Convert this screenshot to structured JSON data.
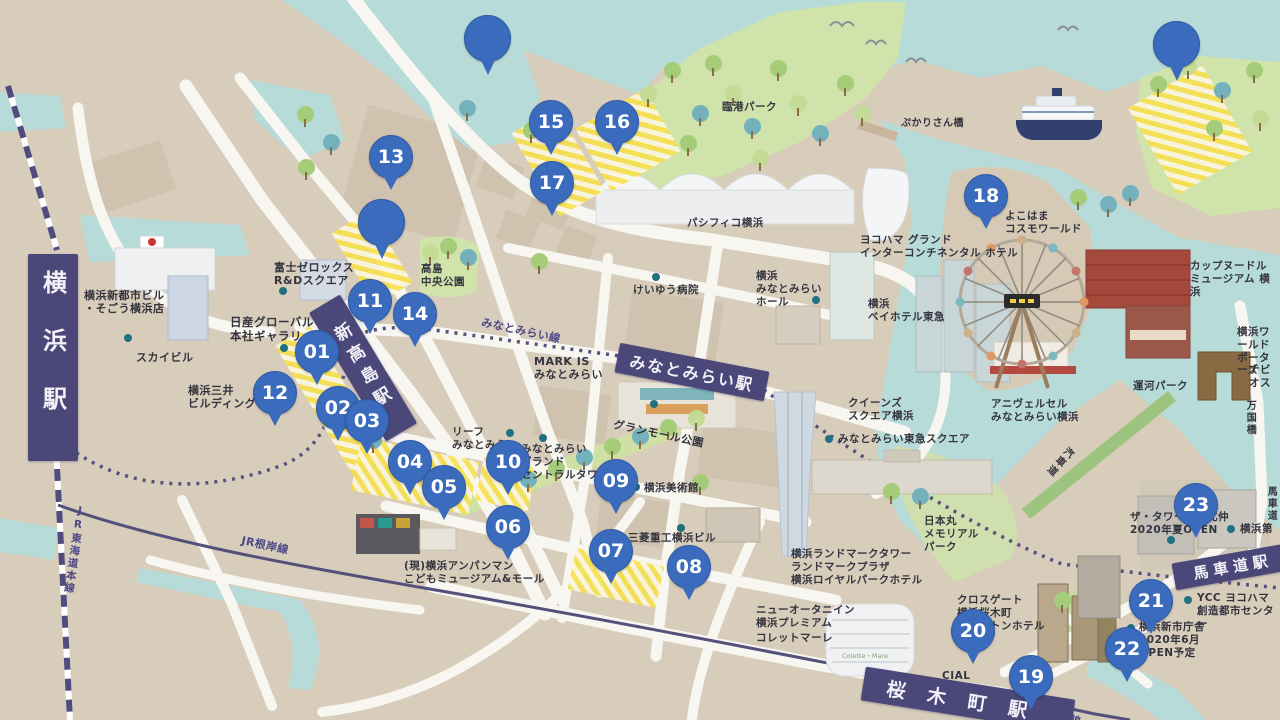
{
  "title": "横浜みなとみらい イラストマップ",
  "colors": {
    "land": "#d8cdbb",
    "water": "#b7dbd8",
    "park": "#cfe3ab",
    "road": "#f8f6f1",
    "rail_purple": "#514c80",
    "station_band": "#4b4778",
    "marker_blue": "#3a6bbd",
    "zone_yellow": "#f6e04e",
    "label_dark": "#34343f"
  },
  "stations": [
    {
      "id": "yokohama",
      "label": "横浜駅",
      "cx": 53,
      "cy": 357,
      "w": 50,
      "h": 207,
      "rot": 0,
      "v": true,
      "fs": 24,
      "ls": 34
    },
    {
      "id": "shin-takashima",
      "label": "新高島駅",
      "cx": 363,
      "cy": 368,
      "w": 36,
      "h": 150,
      "rot": -31,
      "v": true,
      "fs": 17,
      "ls": 8
    },
    {
      "id": "minatomirai",
      "label": "みなとみらい駅",
      "cx": 692,
      "cy": 372,
      "w": 152,
      "h": 30,
      "rot": 11,
      "v": false,
      "fs": 16,
      "ls": 2
    },
    {
      "id": "sakuragicho",
      "label": "桜木町駅",
      "cx": 968,
      "cy": 700,
      "w": 212,
      "h": 34,
      "rot": 9,
      "v": false,
      "fs": 19,
      "ls": 22
    },
    {
      "id": "bashamichi",
      "label": "馬車道駅",
      "cx": 1233,
      "cy": 566,
      "w": 120,
      "h": 27,
      "rot": -10,
      "v": false,
      "fs": 15,
      "ls": 5
    }
  ],
  "markers": [
    {
      "n": "01",
      "x": 317,
      "y": 352
    },
    {
      "n": "02",
      "x": 338,
      "y": 408
    },
    {
      "n": "03",
      "x": 367,
      "y": 421
    },
    {
      "n": "04",
      "x": 410,
      "y": 462
    },
    {
      "n": "05",
      "x": 444,
      "y": 487
    },
    {
      "n": "06",
      "x": 508,
      "y": 527
    },
    {
      "n": "07",
      "x": 611,
      "y": 551
    },
    {
      "n": "08",
      "x": 689,
      "y": 567
    },
    {
      "n": "09",
      "x": 616,
      "y": 481
    },
    {
      "n": "10",
      "x": 508,
      "y": 462
    },
    {
      "n": "11",
      "x": 370,
      "y": 301
    },
    {
      "n": "12",
      "x": 275,
      "y": 393
    },
    {
      "n": "13",
      "x": 391,
      "y": 157
    },
    {
      "n": "14",
      "x": 415,
      "y": 314
    },
    {
      "n": "15",
      "x": 551,
      "y": 122
    },
    {
      "n": "16",
      "x": 617,
      "y": 122
    },
    {
      "n": "17",
      "x": 552,
      "y": 183
    },
    {
      "n": "18",
      "x": 986,
      "y": 196
    },
    {
      "n": "19",
      "x": 1031,
      "y": 677
    },
    {
      "n": "20",
      "x": 973,
      "y": 631
    },
    {
      "n": "21",
      "x": 1151,
      "y": 601
    },
    {
      "n": "22",
      "x": 1127,
      "y": 649
    },
    {
      "n": "23",
      "x": 1196,
      "y": 505
    }
  ],
  "pins": [
    {
      "x": 487,
      "y": 38
    },
    {
      "x": 381,
      "y": 222
    },
    {
      "x": 1176,
      "y": 44
    }
  ],
  "labels": [
    {
      "id": "sogo",
      "t": "横浜新都市ビル\n・そごう横浜店",
      "x": 84,
      "y": 289,
      "fs": 11
    },
    {
      "id": "sky-building",
      "t": "スカイビル",
      "x": 136,
      "y": 351,
      "fs": 11
    },
    {
      "id": "nissan-gallery",
      "t": "日産グローバル\n本社ギャラリー",
      "x": 230,
      "y": 315,
      "fs": 11.5
    },
    {
      "id": "fuji-xerox",
      "t": "富士ゼロックス\nR&Dスクエア",
      "x": 274,
      "y": 261,
      "fs": 11
    },
    {
      "id": "mitsui-building",
      "t": "横浜三井\nビルディング",
      "x": 188,
      "y": 384,
      "fs": 11
    },
    {
      "id": "takashima-central-park",
      "t": "高島\n中央公園",
      "x": 421,
      "y": 263,
      "fs": 10.5
    },
    {
      "id": "keiyu-hospital",
      "t": "けいゆう病院",
      "x": 633,
      "y": 284,
      "fs": 10.5
    },
    {
      "id": "minatomirai-line",
      "t": "みなとみらい線",
      "x": 483,
      "y": 316,
      "fs": 11,
      "rot": 12,
      "c": "rail"
    },
    {
      "id": "mark-is",
      "t": "MARK IS\nみなとみらい",
      "x": 534,
      "y": 355,
      "fs": 11
    },
    {
      "id": "leaf-minatomirai",
      "t": "リーフ\nみなとみらい",
      "x": 452,
      "y": 426,
      "fs": 10.5
    },
    {
      "id": "grand-central-tower",
      "t": "みなとみらい\nグランド\nセントラルタワー",
      "x": 521,
      "y": 443,
      "fs": 10.5
    },
    {
      "id": "grandmall-park",
      "t": "グランモール公園",
      "x": 615,
      "y": 418,
      "fs": 11,
      "rot": 12
    },
    {
      "id": "museum-of-art",
      "t": "横浜美術館",
      "x": 644,
      "y": 482,
      "fs": 10.5
    },
    {
      "id": "mitsubishi-building",
      "t": "三菱重工横浜ビル",
      "x": 628,
      "y": 532,
      "fs": 10.5
    },
    {
      "id": "anpanman-museum",
      "t": "(現)横浜アンパンマン\nこどもミュージアム&モール",
      "x": 404,
      "y": 560,
      "fs": 10.5
    },
    {
      "id": "jr-negishi-line",
      "t": "JR根岸線",
      "x": 243,
      "y": 534,
      "fs": 11,
      "rot": 12,
      "c": "rail"
    },
    {
      "id": "rinko-park",
      "t": "臨港パーク",
      "x": 722,
      "y": 101,
      "fs": 10.5
    },
    {
      "id": "pukarisan-bridge",
      "t": "ぷかりさん橋",
      "x": 901,
      "y": 118,
      "fs": 10
    },
    {
      "id": "pacifico",
      "t": "パシフィコ横浜",
      "x": 687,
      "y": 217,
      "fs": 10.5
    },
    {
      "id": "intercontinental",
      "t": "ヨコハマ グランド\nインターコンチネンタル ホテル",
      "x": 860,
      "y": 234,
      "fs": 10.5
    },
    {
      "id": "cosmo-world",
      "t": "よこはま\nコスモワールド",
      "x": 1005,
      "y": 210,
      "fs": 10.5
    },
    {
      "id": "cupnoodles-museum",
      "t": "カップヌードル\nミュージアム 横浜",
      "x": 1190,
      "y": 260,
      "fs": 10.5
    },
    {
      "id": "mm-hall",
      "t": "横浜\nみなとみらい\nホール",
      "x": 756,
      "y": 270,
      "fs": 10.5
    },
    {
      "id": "bay-hotel",
      "t": "横浜\nベイホテル東急",
      "x": 868,
      "y": 298,
      "fs": 10.5
    },
    {
      "id": "queens-square",
      "t": "クイーンズ\nスクエア横浜",
      "x": 848,
      "y": 397,
      "fs": 10.5
    },
    {
      "id": "tokyu-square",
      "t": "みなとみらい東急スクエア",
      "x": 838,
      "y": 433,
      "fs": 10.5
    },
    {
      "id": "anniversaire",
      "t": "アニヴェルセル\nみなとみらい横浜",
      "x": 991,
      "y": 398,
      "fs": 10.5
    },
    {
      "id": "unga-park",
      "t": "運河パーク",
      "x": 1133,
      "y": 380,
      "fs": 10.5
    },
    {
      "id": "world-porters",
      "t": "横浜ワールド\nポーターズ",
      "x": 1237,
      "y": 326,
      "fs": 10.5
    },
    {
      "id": "navios",
      "t": "ナビオス",
      "x": 1249,
      "y": 364,
      "fs": 10.5
    },
    {
      "id": "bankoku-bridge",
      "t": "万国橋",
      "x": 1243,
      "y": 400,
      "fs": 10,
      "v": true
    },
    {
      "id": "kishamichi",
      "t": "汽車道",
      "x": 1066,
      "y": 443,
      "fs": 10,
      "v": true,
      "rot": 42
    },
    {
      "id": "nippon-maru-park",
      "t": "日本丸\nメモリアル\nパーク",
      "x": 924,
      "y": 515,
      "fs": 10.5
    },
    {
      "id": "landmark-tower",
      "t": "横浜ランドマークタワー\nランドマークプラザ\n横浜ロイヤルパークホテル",
      "x": 791,
      "y": 548,
      "fs": 10.5
    },
    {
      "id": "new-otani-inn",
      "t": "ニューオータニイン\n横浜プレミアム",
      "x": 756,
      "y": 604,
      "fs": 10.5
    },
    {
      "id": "colette-mare",
      "t": "コレットマーレ",
      "x": 756,
      "y": 632,
      "fs": 10.5
    },
    {
      "id": "colette-sign",
      "t": "Colette・Mare",
      "x": 842,
      "y": 653,
      "fs": 6.5,
      "c": "sign"
    },
    {
      "id": "crossgate",
      "t": "クロスゲート\n横浜桜木町\nワシントンホテル",
      "x": 957,
      "y": 594,
      "fs": 10.5
    },
    {
      "id": "cial-sakuragicho",
      "t": "CIAL\n桜木町",
      "x": 942,
      "y": 670,
      "fs": 10.5
    },
    {
      "id": "ycc",
      "t": "YCC ヨコハマ\n創造都市センター",
      "x": 1197,
      "y": 592,
      "fs": 10.5
    },
    {
      "id": "new-city-hall",
      "t": "横浜新市庁舎\n2020年6月\nOPEN予定",
      "x": 1139,
      "y": 621,
      "fs": 10.5
    },
    {
      "id": "tower-kitanaka",
      "t": "ザ・タワー横浜北仲\n2020年夏OPEN",
      "x": 1130,
      "y": 511,
      "fs": 10.5
    },
    {
      "id": "yokohama-daini",
      "t": "横浜第",
      "x": 1240,
      "y": 523,
      "fs": 10.5
    },
    {
      "id": "bashamichi-street",
      "t": "馬車道",
      "x": 1264,
      "y": 486,
      "fs": 10,
      "v": true
    },
    {
      "id": "jr-tokaido-line",
      "t": "JR東海道本線",
      "x": 74,
      "y": 504,
      "fs": 10.5,
      "v": true,
      "rot": 8,
      "c": "rail"
    },
    {
      "id": "jr-negishi-line-2",
      "t": "JR根岸線",
      "x": 1038,
      "y": 704,
      "fs": 10.5,
      "rot": 16,
      "c": "rail"
    }
  ],
  "zones": [
    {
      "cx": 372,
      "cy": 258,
      "w": 44,
      "h": 84,
      "rot": -31
    },
    {
      "cx": 331,
      "cy": 400,
      "w": 40,
      "h": 150,
      "rot": -31
    },
    {
      "cx": 558,
      "cy": 162,
      "w": 52,
      "h": 96,
      "rot": -30
    },
    {
      "cx": 628,
      "cy": 140,
      "w": 80,
      "h": 72,
      "rot": -30
    },
    {
      "cx": 415,
      "cy": 476,
      "w": 120,
      "h": 54,
      "rot": 12
    },
    {
      "cx": 506,
      "cy": 484,
      "w": 54,
      "h": 44,
      "rot": 12
    },
    {
      "cx": 616,
      "cy": 578,
      "w": 90,
      "h": 42,
      "rot": 12
    },
    {
      "cx": 1190,
      "cy": 130,
      "w": 86,
      "h": 100,
      "rot": -30
    }
  ],
  "dots": [
    [
      283,
      291
    ],
    [
      128,
      338
    ],
    [
      284,
      348
    ],
    [
      656,
      277
    ],
    [
      654,
      404
    ],
    [
      510,
      433
    ],
    [
      543,
      438
    ],
    [
      636,
      487
    ],
    [
      681,
      528
    ],
    [
      816,
      300
    ],
    [
      829,
      439
    ],
    [
      934,
      689
    ],
    [
      1188,
      600
    ],
    [
      1131,
      628
    ],
    [
      1171,
      540
    ],
    [
      1231,
      529
    ]
  ],
  "trees": [
    [
      305,
      114,
      "g"
    ],
    [
      331,
      142,
      "t"
    ],
    [
      306,
      167,
      "g"
    ],
    [
      467,
      108,
      "t"
    ],
    [
      531,
      130,
      "g"
    ],
    [
      430,
      252,
      "l"
    ],
    [
      448,
      246,
      "g"
    ],
    [
      468,
      257,
      "t"
    ],
    [
      648,
      94,
      "l"
    ],
    [
      672,
      70,
      "g"
    ],
    [
      700,
      113,
      "t"
    ],
    [
      713,
      63,
      "g"
    ],
    [
      733,
      93,
      "l"
    ],
    [
      752,
      126,
      "t"
    ],
    [
      778,
      68,
      "g"
    ],
    [
      798,
      103,
      "l"
    ],
    [
      820,
      133,
      "t"
    ],
    [
      845,
      83,
      "g"
    ],
    [
      862,
      113,
      "l"
    ],
    [
      688,
      143,
      "g"
    ],
    [
      760,
      158,
      "l"
    ],
    [
      539,
      261,
      "g"
    ],
    [
      528,
      479,
      "t"
    ],
    [
      556,
      468,
      "g"
    ],
    [
      584,
      457,
      "t"
    ],
    [
      612,
      446,
      "g"
    ],
    [
      640,
      436,
      "t"
    ],
    [
      668,
      427,
      "g"
    ],
    [
      696,
      418,
      "l"
    ],
    [
      700,
      482,
      "g"
    ],
    [
      891,
      491,
      "g"
    ],
    [
      920,
      496,
      "t"
    ],
    [
      1158,
      84,
      "g"
    ],
    [
      1188,
      66,
      "l"
    ],
    [
      1222,
      90,
      "t"
    ],
    [
      1254,
      70,
      "g"
    ],
    [
      1260,
      118,
      "l"
    ],
    [
      1214,
      128,
      "g"
    ],
    [
      1130,
      193,
      "t"
    ],
    [
      1078,
      197,
      "g"
    ],
    [
      1108,
      204,
      "t"
    ],
    [
      373,
      440,
      "t"
    ],
    [
      1062,
      600,
      "g"
    ]
  ]
}
